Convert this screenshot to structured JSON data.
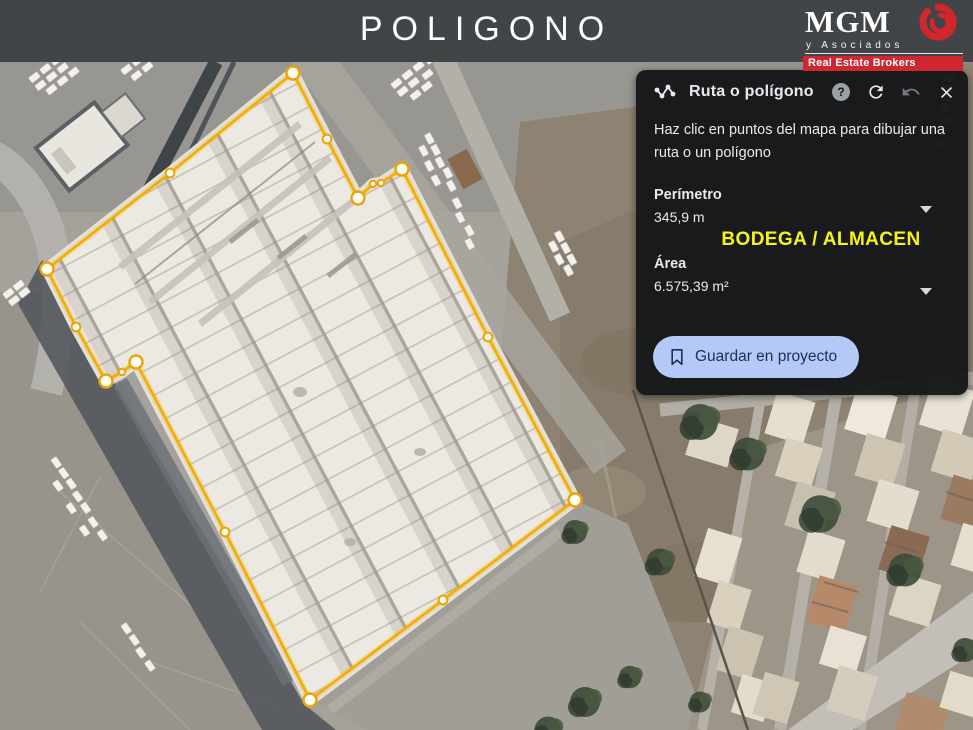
{
  "banner": {
    "title": "POLIGONO",
    "logo": {
      "name": "MGM",
      "subtitle": "y Asociados",
      "tagline": "Real Estate Brokers",
      "accent_red": "#cf2630"
    }
  },
  "panel": {
    "title": "Ruta o polígono",
    "instructions": "Haz clic en puntos del mapa para dibujar una ruta o un polígono",
    "perimeter_label": "Perímetro",
    "perimeter_value": "345,9 m",
    "area_label": "Área",
    "area_value": "6.575,39 m²",
    "save_button_label": "Guardar en proyecto",
    "icons": {
      "route": "route-icon",
      "help": "help-icon",
      "redo": "redo-icon",
      "undo": "undo-icon",
      "close": "close-icon",
      "bookmark": "bookmark-icon",
      "expand_carets": "chevron-down-icon"
    },
    "help_glyph": "?",
    "background": "#161718",
    "button_bg": "#b4c9f8",
    "button_text_color": "#17315f"
  },
  "map_overlay": {
    "annotation": "BODEGA / ALMACEN",
    "annotation_color": "#f4f415",
    "polygon_color": "#f2ae00",
    "vertex_fill": "#fffdf4"
  }
}
